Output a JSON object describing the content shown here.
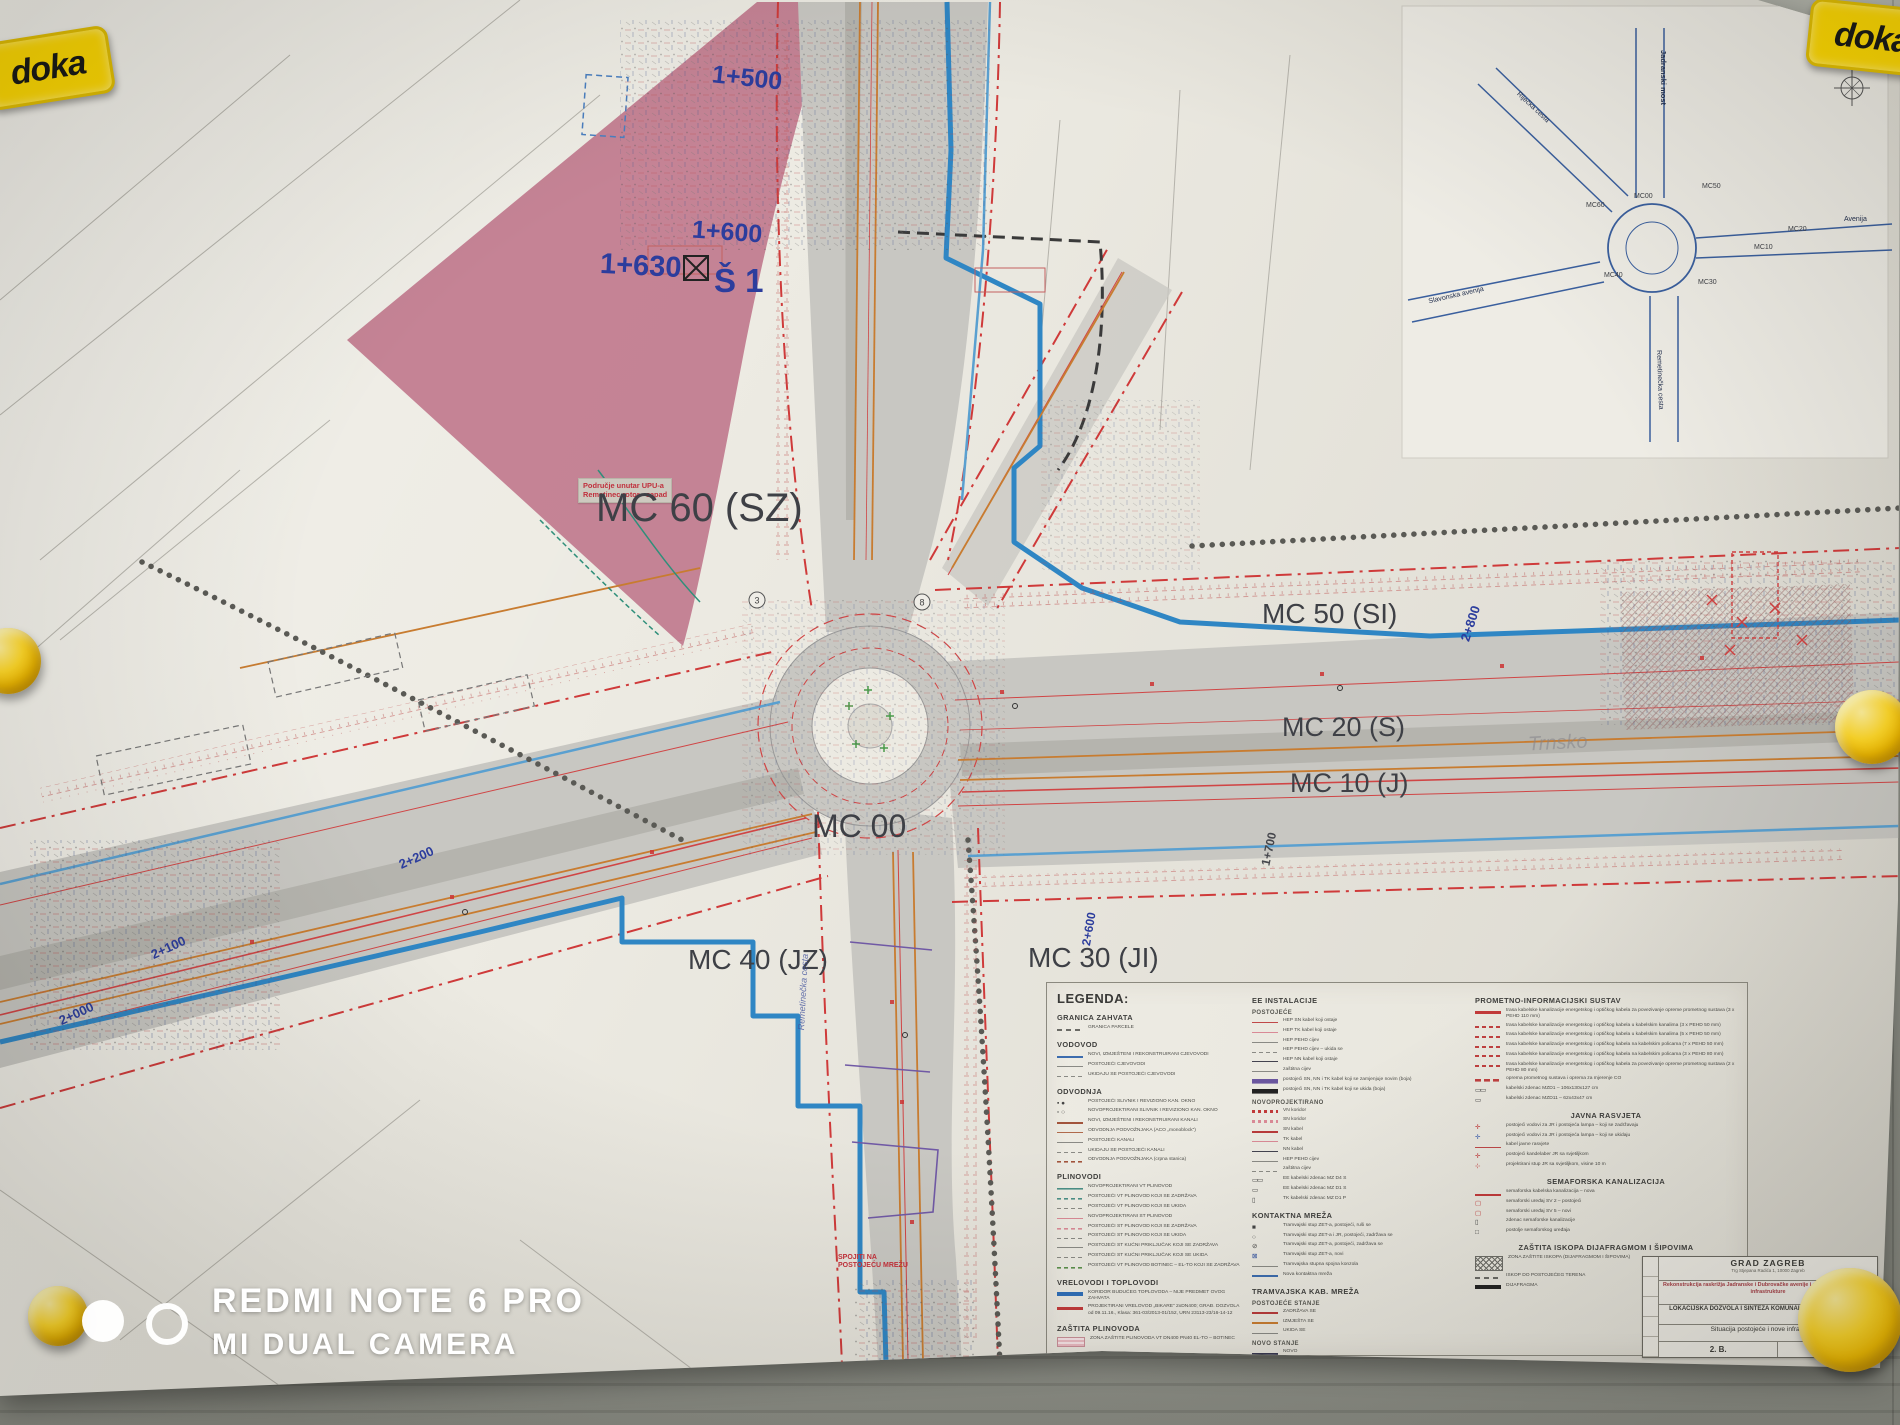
{
  "scene": {
    "brand_logo": "doka",
    "colors": {
      "pink_zone": "#c27d90",
      "road_gray": "#c8c7c2",
      "blue_main": "#2f86c4",
      "red_boundary": "#cf3a3a",
      "orange_utility": "#c87c30",
      "paper": "#edebe3",
      "wall": "#a7a9a0",
      "magnet_yellow": "#ffd829"
    }
  },
  "watermark": {
    "line1": "REDMI NOTE 6 PRO",
    "line2": "MI DUAL CAMERA"
  },
  "project_blocks": {
    "b1": {
      "title": [
        "Rekonstrukcija - izgradnja prometnice oznake „3”",
        "na području UPU-a Remetinec rotor - zapad",
        "sa pripadajućom komunalnom infrastrukturom"
      ],
      "info": [
        "Investitor: Grad Zagreb, Trg Stjepana Radića 1, Zagreb",
        "Naručitelj: Rotor Jug d.o.o., Radnička cesta 52, 10000 Zagreb",
        "Projektant: Labos d.o.o., Pavlinska 5, 42000 Varaždin",
        "ZOP: 244/16",
        "Datum: prosinac, 2016.",
        "Glavni projektant: Bojan Gorski, dipl.ing.građ."
      ]
    },
    "b2": {
      "title": [
        "Rekonstrukcija - izgradnja prometnice oznake „1”",
        "na području UPU-a Remetinec rotor - zapad",
        "sa pripadajućom komunalnom infrastrukturom"
      ],
      "info": [
        "Investitor: Grad Zagreb, Trg Stjepana Radića 1, Zagreb",
        "Naručitelj: Rotor Jug d.o.o., Radnička cesta 52, 10000 Zagreb",
        "Projektant: Labos d.o.o., Pavlinska 5, 42000 Varaždin",
        "ZOP: 241/16",
        "Datum: prosinac, 2016.",
        "Glavni projektant: Bojan Gorski, dipl.ing.građ."
      ]
    },
    "b3": {
      "title": [
        "Rekonstrukcija - izgradnja prometnice oznake „2”",
        "na području UPU-a Remetinec rotor - zapad",
        "sa pripadajućom komunalnom infrastrukturom"
      ],
      "info": [
        "Investitor: Grad Zagreb, Trg Stjepana Radića 1, Zagreb",
        "Naručitelj: Rotor Jug d.o.o., Radnička cesta 52, 10000 Zagreb",
        "Projektant: Labos d.o.o., Pavlinska 5, 42000 Varaždin",
        "ZOP: 243/16",
        "Datum: prosinac, 2016.",
        "Glavni projektant: Bojan Gorski, dipl.ing.građ."
      ]
    }
  },
  "plan": {
    "labels": {
      "mc60": "MC 60 (SZ)",
      "mc50": "MC 50 (SI)",
      "mc20": "MC 20 (S)",
      "mc10": "MC 10 (J)",
      "mc00": "MC 00",
      "mc40": "MC 40 (JZ)",
      "mc30": "MC 30 (JI)",
      "ch1500": "1+500",
      "ch1600": "1+600",
      "ch1630": "1+630",
      "s1": "Š 1",
      "ch2800": "2+800",
      "ch1700": "1+700",
      "ch2000": "2+000",
      "ch2100": "2+100",
      "ch2200": "2+200",
      "ch2600": "2+600",
      "district": "Trnsko",
      "street_south": "Remetinečka cesta",
      "spojiti_l1": "SPOJITI NA",
      "spojiti_l2": "POSTOJEĆU MREŽU",
      "area_l1": "Područje unutar UPU-a",
      "area_l2": "Remetinec rotor - zapad"
    }
  },
  "inset": {
    "roads": {
      "jadranski": "Jadranski most",
      "rijecka": "Riječka cesta",
      "slavonska": "Slavonska avenija",
      "avenija": "Avenija",
      "remetinecka": "Remetinečka cesta"
    },
    "nodes": {
      "mc60": "MC60",
      "mc00": "MC00",
      "mc50": "MC50",
      "mc20": "MC20",
      "mc10": "MC10",
      "mc40": "MC40",
      "mc30": "MC30"
    },
    "compass": "N"
  },
  "legend": {
    "title": "LEGENDA:",
    "col1": [
      {
        "header": "GRANICA ZAHVATA",
        "items": [
          {
            "sw": "sw-dashsq",
            "t": "GRANICA PARCELE"
          }
        ]
      },
      {
        "header": "VODOVOD",
        "items": [
          {
            "sw": "sw-blue2",
            "t": "NOVI, IZMJEŠTENI I REKONSTRUIRANI CJEVOVODI"
          },
          {
            "sw": "sw-gray1",
            "t": "POSTOJEĆI CJEVOVODI"
          },
          {
            "sw": "sw-graydash",
            "t": "UKIDAJU SE POSTOJEĆI CJEVOVODI"
          }
        ]
      },
      {
        "header": "ODVODNJA",
        "items": [
          {
            "sw": "sw-symsl1",
            "t": "POSTOJEĆI SLIVNIK I REVIZIONO KAN. OKNO"
          },
          {
            "sw": "sw-symsl2",
            "t": "NOVOPROJEKTIRANI SLIVNIK I REVIZIONO KAN. OKNO"
          },
          {
            "sw": "sw-brown2",
            "t": "NOVI, IZMJEŠTENI I REKONSTRUIRANI KANALI"
          },
          {
            "sw": "sw-brown1",
            "t": "ODVODNJA PODVOŽNJAKA (ACO „monoblock”)"
          },
          {
            "sw": "sw-gray1",
            "t": "POSTOJEĆI KANALI"
          },
          {
            "sw": "sw-graydash",
            "t": "UKIDAJU SE POSTOJEĆI KANALI"
          },
          {
            "sw": "sw-browndash",
            "t": "ODVODNJA PODVOŽNJAKA (crpna stanica)"
          }
        ]
      },
      {
        "header": "PLINOVODI",
        "items": [
          {
            "sw": "sw-teal1",
            "t": "NOVOPROJEKTIRANI VT PLINOVOD"
          },
          {
            "sw": "sw-tealdash",
            "t": "POSTOJEĆI VT PLINOVOD KOJI SE ZADRŽAVA"
          },
          {
            "sw": "sw-graydash",
            "t": "POSTOJEĆI VT PLINOVOD KOJI SE UKIDA"
          },
          {
            "sw": "sw-pink1",
            "t": "NOVOPROJEKTIRANI ST PLINOVOD"
          },
          {
            "sw": "sw-pinkdash",
            "t": "POSTOJEĆI ST PLINOVOD KOJI SE ZADRŽAVA"
          },
          {
            "sw": "sw-graydash",
            "t": "POSTOJEĆI ST PLINOVOD KOJI SE UKIDA"
          },
          {
            "sw": "sw-gray1",
            "t": "POSTOJEĆI ST KUĆNI PRIKLJUČAK KOJI SE ZADRŽAVA"
          },
          {
            "sw": "sw-graydash",
            "t": "POSTOJEĆI ST KUĆNI PRIKLJUČAK KOJI SE UKIDA"
          },
          {
            "sw": "sw-greendash",
            "t": "POSTOJEĆI VT PLINOVOD BOTINEC – EL-TO KOJI SE ZADRŽAVA"
          }
        ]
      },
      {
        "header": "VRELOVODI I TOPLOVODI",
        "items": [
          {
            "sw": "sw-blue4",
            "t": "KORIDOR BUDUĆEG TOPLOVODA – NIJE PREDMET OVOG ZAHVATA"
          },
          {
            "sw": "sw-red3",
            "t": "PROJEKTIRANI VRELOVOD „BIKARE” 2xDN400; GRAĐ. DOZVOLA od 09.11.16., Klasa: 361-03/2013-01/152, URN 23113-23/16-14-12"
          }
        ]
      },
      {
        "header": "ZAŠTITA PLINOVODA",
        "items": [
          {
            "sw": "sw-zone",
            "t": "ZONA ZAŠTITE PLINOVODA VT DN400 PN40 EL-TO – BOTINEC"
          }
        ]
      },
      {
        "header": "DTK I TK",
        "items": [
          {
            "sw": "sw-purp2",
            "t": "NOVA DTK (prema posebnim uvjetima ZGS) – 4xPVCØ110 + 4xPEHDØ50 cijevi"
          },
          {
            "sw": "sw-purp1",
            "t": "POSTOJEĆA DTK (zaštićuje se) – 24xPVCØ110 cijevi; svjetlovodni i prespojnički kabel"
          },
          {
            "sw": "sw-gray1",
            "t": "POSTOJEĆA DTK (ostaje) – PVC i PEHD cijevi; svjetlovodni i prespojnički kabel"
          },
          {
            "sw": "sw-graydash",
            "t": "POSTOJEĆI TK KABEL (ostaje) – prespojnički kabel"
          },
          {
            "sw": "sw-graydot",
            "t": "POSTOJEĆA DTK (napušta se) – 24xPVCØ110 cijevi; svjetlovodni i prespojnički kabel"
          }
        ]
      }
    ],
    "col2": [
      {
        "header": "EE INSTALACIJE"
      },
      {
        "header": "POSTOJEĆE",
        "cls": "sub",
        "items": [
          {
            "sw": "sw-red1",
            "t": "HEP SN kabel koji ostaje"
          },
          {
            "sw": "sw-pink1",
            "t": "HEP TK kabel koji ostaje"
          },
          {
            "sw": "sw-gray1",
            "t": "HEP PEHD cijev"
          },
          {
            "sw": "sw-graydash",
            "t": "HEP PEHD cijev – ukida se"
          },
          {
            "sw": "sw-dark1",
            "t": "HEP NN kabel koji ostaje"
          },
          {
            "sw": "sw-gray1",
            "t": "zaštitna cijev"
          },
          {
            "sw": "sw-purpband",
            "t": "postojeći SN, NN i TK kabel koji se zamjenjuje novim (boja)"
          },
          {
            "sw": "sw-blkband",
            "t": "postojeći SN, NN i TK kabel koji se ukida (boja)"
          }
        ]
      },
      {
        "header": "NOVOPROJEKTIRANO",
        "cls": "sub",
        "items": [
          {
            "sw": "sw-reddots",
            "t": "VN koridor"
          },
          {
            "sw": "sw-pinkdots",
            "t": "SN koridor"
          },
          {
            "sw": "sw-red2",
            "t": "SN kabel"
          },
          {
            "sw": "sw-pink1",
            "t": "TK kabel"
          },
          {
            "sw": "sw-dark1",
            "t": "NN kabel"
          },
          {
            "sw": "sw-gray1",
            "t": "HEP PEHD cijev"
          },
          {
            "sw": "sw-graydash",
            "t": "zaštitna cijev"
          },
          {
            "sw": "sw-zd4",
            "t": "EE kabelski zdenac MZ D4 S"
          },
          {
            "sw": "sw-zd1",
            "t": "EE kabelski zdenac MZ D1 S"
          },
          {
            "sw": "sw-zd1o",
            "t": "TK kabelski zdenac MZ D1 P"
          }
        ]
      },
      {
        "header": "KONTAKTNA MREŽA",
        "items": [
          {
            "sw": "sw-sqf",
            "t": "Tramvajski stup ZET-a, postojeći, ruši se"
          },
          {
            "sw": "sw-circ",
            "t": "Tramvajski stup ZET-a i JR, postojeći, zadržava se"
          },
          {
            "sw": "sw-circx",
            "t": "Tramvajski stup ZET-a, postojeći, zadržava se"
          },
          {
            "sw": "sw-sqx",
            "t": "Tramvajski stup ZET-a, novi"
          },
          {
            "sw": "sw-gray1",
            "t": "Tramvajska stupna spojna konzola"
          },
          {
            "sw": "sw-blue2",
            "t": "Nova kontaktna mreža"
          }
        ]
      },
      {
        "header": "TRAMVAJSKA KAB. MREŽA"
      },
      {
        "header": "POSTOJEĆE STANJE",
        "cls": "sub",
        "items": [
          {
            "sw": "sw-red2",
            "t": "ZADRŽAVA SE"
          },
          {
            "sw": "sw-orange2",
            "t": "IZMJEŠTA SE"
          },
          {
            "sw": "sw-gray1",
            "t": "UKIDA SE"
          }
        ]
      },
      {
        "header": "NOVO STANJE",
        "cls": "sub",
        "items": [
          {
            "sw": "sw-dark2",
            "t": "NOVO"
          },
          {
            "sw": "sw-purp2",
            "t": "POSTOJEĆE NA NOVOJ PODLOZI"
          }
        ]
      }
    ],
    "col3": [
      {
        "header": "PROMETNO-INFORMACIJSKI SUSTAV",
        "items": [
          {
            "sw": "sw-red3",
            "t": "trasa kabelske kanalizacije energetskog i optičkog kabela za povezivanje opreme prometnog sustava (3 x PEHD 110 mm)"
          },
          {
            "sw": "sw-reddots2",
            "t": "trasa kabelske kanalizacije energetskog i optičkog kabela u kabelskim kanalima (3 x PEHD 50 mm)"
          },
          {
            "sw": "sw-reddots2",
            "t": "trasa kabelske kanalizacije energetskog i optičkog kabela u kabelskim kanalima (5 x PEHD 50 mm)"
          },
          {
            "sw": "sw-reddots2",
            "t": "trasa kabelske kanalizacije energetskog i optičkog kabela na kabelskim policama (7 x PEHD 50 mm)"
          },
          {
            "sw": "sw-reddots2",
            "t": "trasa kabelske kanalizacije energetskog i optičkog kabela na kabelskim policama (3 x PEHD 80 mm)"
          },
          {
            "sw": "sw-reddots2",
            "t": "trasa kabelske kanalizacije energetskog i optičkog kabela za povezivanje opreme prometnog sustava (2 x PEHD 80 mm)"
          },
          {
            "sw": "sw-redd2",
            "t": "oprema prometnog sustava i oprema za mjerenje CO"
          },
          {
            "sw": "sw-zd4",
            "t": "kabelski zdenac MZD1 – 106x130x127 cm"
          },
          {
            "sw": "sw-zd1",
            "t": "kabelski zdenac MZD11 – 62x43x47 cm"
          }
        ]
      },
      {
        "header": "JAVNA RASVJETA",
        "cls": "ctr",
        "items": [
          {
            "sw": "sw-lampr",
            "t": "postojeći vodovi za JR i postojeća lampa – koji se zadržavaju"
          },
          {
            "sw": "sw-lampb",
            "t": "postojeći vodovi za JR i postojeća lampa – koji se ukidaju"
          },
          {
            "sw": "sw-red1",
            "t": "kabel javne rasvjete"
          },
          {
            "sw": "sw-lampr",
            "t": "postojeći kandelaber JR sa svjetiljkom"
          },
          {
            "sw": "sw-lampn",
            "t": "projektirani stup JR sa svjetiljkom, visine 10 m"
          }
        ]
      },
      {
        "header": "SEMAFORSKA KANALIZACIJA",
        "cls": "ctr",
        "items": [
          {
            "sw": "sw-redu",
            "t": "semaforska kabelska kanalizacija – nova"
          },
          {
            "sw": "sw-sqsv",
            "t": "semaforski uređaj SV 2 – postojeći"
          },
          {
            "sw": "sw-sqsv",
            "t": "semaforski uređaj SV 5 – novi"
          },
          {
            "sw": "sw-zd1o",
            "t": "zdenac semaforske kanalizacije"
          },
          {
            "sw": "sw-sqo",
            "t": "postolje semaforskog uređaja"
          }
        ]
      },
      {
        "header": "ZAŠTITA ISKOPA DIJAFRAGMOM I ŠIPOVIMA",
        "cls": "ctr",
        "items": [
          {
            "sw": "sw-hatch",
            "t": "ZONA ZAŠTITE ISKOPA (DIJAFRAGMOM I ŠIPOVIMA)"
          },
          {
            "sw": "sw-dashsq",
            "t": "ISKOP DO POSTOJEĆEG TERENA"
          },
          {
            "sw": "sw-blk4",
            "t": "DIJAFRAGMA"
          }
        ]
      }
    ]
  },
  "title_block": {
    "org": "GRAD ZAGREB",
    "org_addr": "Trg Stjepana Radića 1, 10000 Zagreb",
    "project": "Rekonstrukcija raskrižja Jadranske i Dubrovačke avenije i pripadajuće komunalne infrastrukture",
    "phase": "LOKACIJSKA DOZVOLA I SINTEZA KOMUNALNE INFRASTRUKTURE",
    "drawing": "Situacija postojeće i nove infrastrukture",
    "number": "2. B."
  }
}
